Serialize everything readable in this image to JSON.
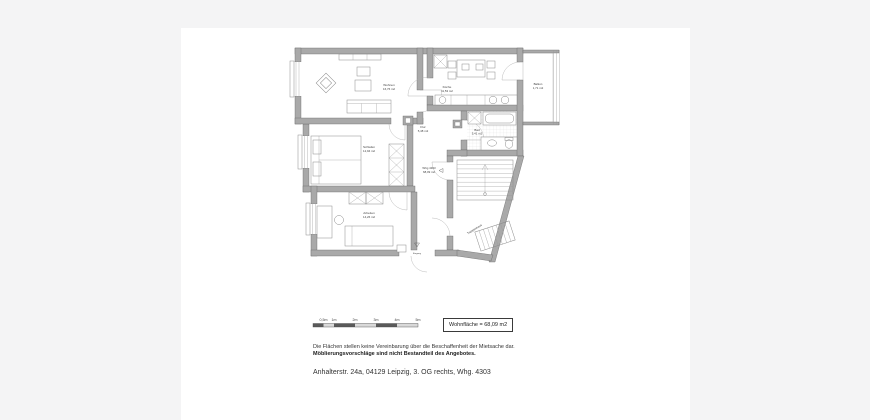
{
  "page": {
    "background_color": "#f4f4f5",
    "card_color": "#ffffff",
    "wall_color": "#a9a9a9",
    "line_color": "#8a8a8a"
  },
  "plan": {
    "rooms": [
      {
        "id": "wohnen",
        "name": "Wohnen",
        "area": "16,76 m2"
      },
      {
        "id": "kueche",
        "name": "Küche",
        "area": "11,53 m2"
      },
      {
        "id": "balkon",
        "name": "Balkon",
        "area": "1,71 m2"
      },
      {
        "id": "flur",
        "name": "Flur",
        "area": "5,48 m2"
      },
      {
        "id": "bad",
        "name": "Bad",
        "area": "5,41 m2"
      },
      {
        "id": "schlafen",
        "name": "Schlafen",
        "area": "12,94 m2"
      },
      {
        "id": "arbeiten",
        "name": "Arbeiten",
        "area": "14,26 m2"
      }
    ],
    "apartment_label": {
      "name": "Whg 4303",
      "area": "68,09 m2"
    },
    "staircase_label": "Treppenhaus",
    "entrance_label": "Eingang"
  },
  "scale_bar": {
    "labels": [
      "0,5m",
      "1m",
      "2m",
      "3m",
      "4m",
      "5m"
    ]
  },
  "area_box": {
    "label": "Wohnfläche = 68,09 m2"
  },
  "notes": {
    "line1": "Die Flächen stellen keine Vereinbarung über die Beschaffenheit der Mietsache dar.",
    "line2": "Möblierungsvorschläge sind nicht Bestandteil des Angebotes."
  },
  "address": "Anhalterstr. 24a, 04129 Leipzig, 3. OG rechts, Whg. 4303"
}
